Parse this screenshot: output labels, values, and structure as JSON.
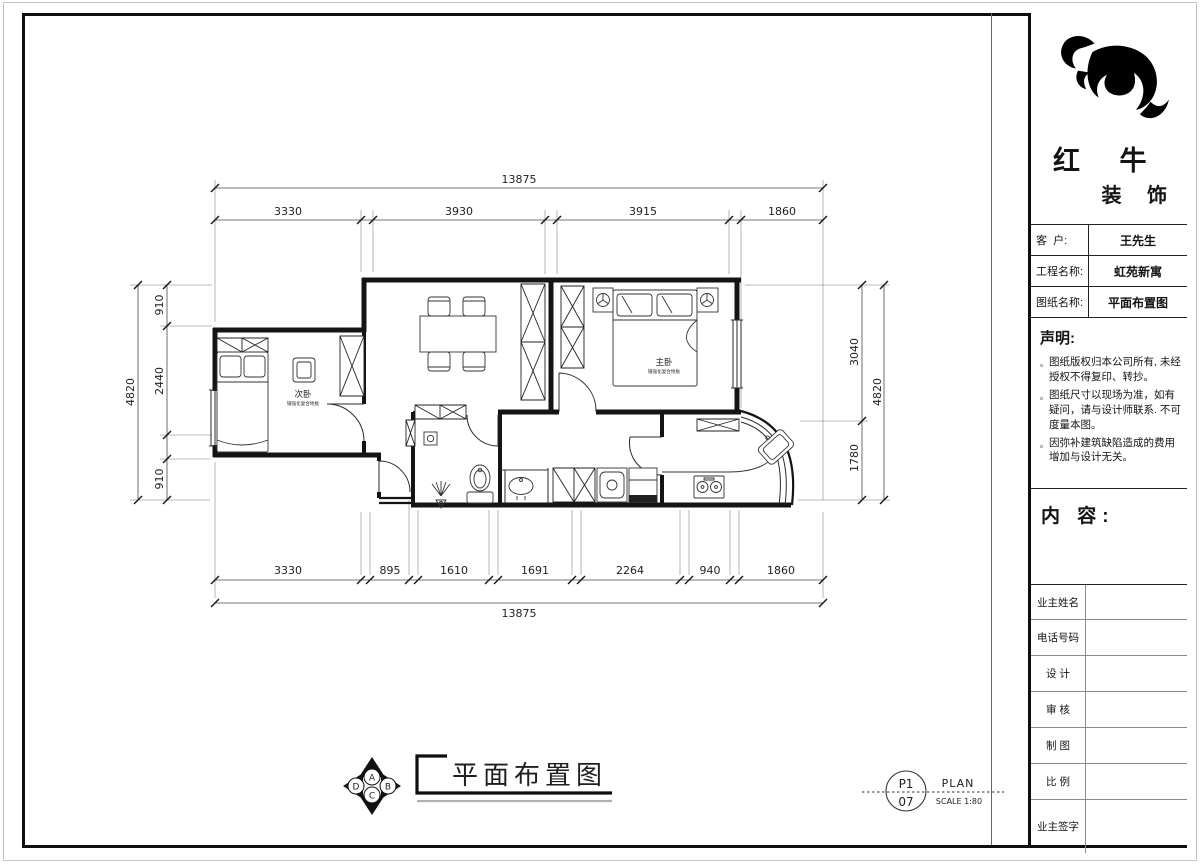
{
  "colors": {
    "ink": "#141414",
    "dim_line": "#4a4a4a",
    "frame": "#0e0e0e",
    "underline_gray": "#b0b0b0",
    "paper": "#ffffff"
  },
  "plan": {
    "dims": {
      "top_total": "13875",
      "top_segments": [
        "3330",
        "3930",
        "3915",
        "1860"
      ],
      "bottom_segments": [
        "3330",
        "895",
        "1610",
        "1691",
        "2264",
        "940",
        "1860"
      ],
      "bottom_total": "13875",
      "left_segments": [
        "910",
        "2440",
        "910"
      ],
      "left_total": "4820",
      "right_segments": [
        "3040",
        "1780"
      ],
      "right_total": "4820"
    },
    "rooms": {
      "secondary_bedroom": {
        "name": "次卧",
        "note": "铺强化复合地板"
      },
      "master_bedroom": {
        "name": "主卧",
        "note": "铺强化复合地板"
      }
    }
  },
  "footer": {
    "compass": {
      "n": "A",
      "e": "B",
      "s": "C",
      "w": "D"
    },
    "sheet_title": "平面布置图",
    "stamp": {
      "code_top": "P1",
      "code_bottom": "07",
      "type": "PLAN",
      "scale": "SCALE 1:80"
    }
  },
  "titleblock": {
    "brand": {
      "line1": "红 牛",
      "line2": "装 饰"
    },
    "info_rows": [
      {
        "label": "客  户:",
        "value": "王先生"
      },
      {
        "label": "工程名称:",
        "value": "虹苑新寓"
      },
      {
        "label": "图纸名称:",
        "value": "平面布置图"
      }
    ],
    "statement": {
      "title": "声明:",
      "bullet": "。",
      "items": [
        "图纸版权归本公司所有, 未经授权不得复印、转抄。",
        "图纸尺寸以现场为准，如有疑问，请与设计师联系. 不可度量本图。",
        "因弥补建筑缺陷造成的费用增加与设计无关。"
      ]
    },
    "content_label": "内 容:",
    "sign_rows": [
      "业主姓名",
      "电话号码",
      "设 计",
      "审 核",
      "制 图",
      "比 例",
      "业主签字"
    ]
  }
}
